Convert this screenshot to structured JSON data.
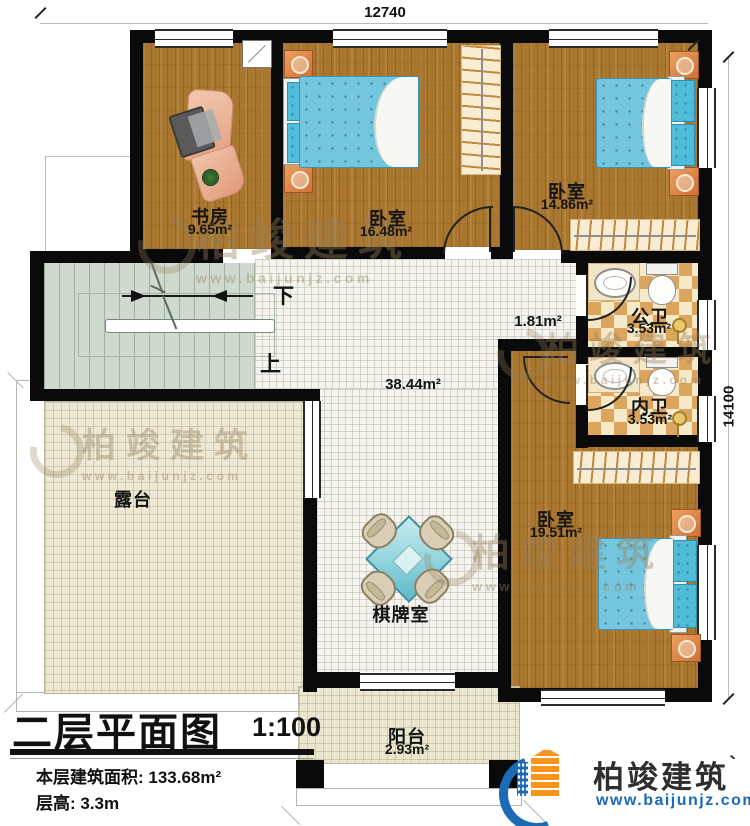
{
  "dimensions": {
    "top": "12740",
    "right": "14100"
  },
  "rooms": {
    "study": {
      "name": "书房",
      "area": "9.65m²"
    },
    "bedroom_top": {
      "name": "卧室",
      "area": "16.48m²"
    },
    "bedroom_right": {
      "name": "卧室",
      "area": "14.86m²"
    },
    "public_bath": {
      "name": "公卫",
      "area": "3.53m²"
    },
    "inner_bath": {
      "name": "内卫",
      "area": "3.53m²"
    },
    "bedroom_bottom": {
      "name": "卧室",
      "area": "19.51m²"
    },
    "terrace": {
      "name": "露台"
    },
    "game_room": {
      "name": "棋牌室"
    },
    "balcony": {
      "name": "阳台",
      "area": "2.93m²"
    },
    "hall": {
      "area": "38.44m²"
    },
    "corridor": {
      "area": "1.81m²"
    }
  },
  "stairs": {
    "down": "下",
    "up": "上"
  },
  "title_block": {
    "title": "二层平面图",
    "scale": "1:100",
    "floor_area": "本层建筑面积: 133.68m²",
    "floor_height": "层高: 3.3m"
  },
  "brand": {
    "name": "柏竣建筑",
    "tick": "`",
    "website": "www.baijunjz.com"
  },
  "watermark": {
    "text": "柏竣建筑",
    "website": "www.baijunjz.com"
  },
  "colors": {
    "wall": "#0a0a0a",
    "wood": "#a9772f",
    "bed": "#74c6df",
    "logo_blue": "#1a6ab5",
    "logo_orange": "#f7941e"
  }
}
